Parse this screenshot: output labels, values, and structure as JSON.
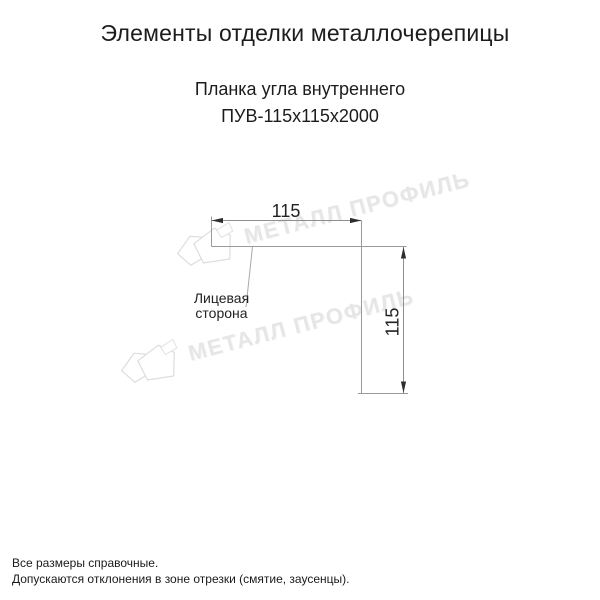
{
  "header": {
    "title": "Элементы отделки металлочерепицы",
    "product_name": "Планка угла внутреннего",
    "product_code": "ПУВ-115х115х2000"
  },
  "diagram": {
    "width_label": "115",
    "height_label": "115",
    "face_side_line1": "Лицевая",
    "face_side_line2": "сторона"
  },
  "watermark": {
    "text": "МЕТАЛЛ ПРОФИЛЬ",
    "color": "#e6e6e6"
  },
  "footer": {
    "note1": "Все размеры справочные.",
    "note2": "Допускаются отклонения в зоне отрезки (смятие, заусенцы)."
  },
  "colors": {
    "background": "#ffffff",
    "text": "#1c1c1c",
    "profile_line": "#9a9a9a",
    "dimension_line": "#8f8f8f",
    "arrow": "#2e2e2e"
  }
}
